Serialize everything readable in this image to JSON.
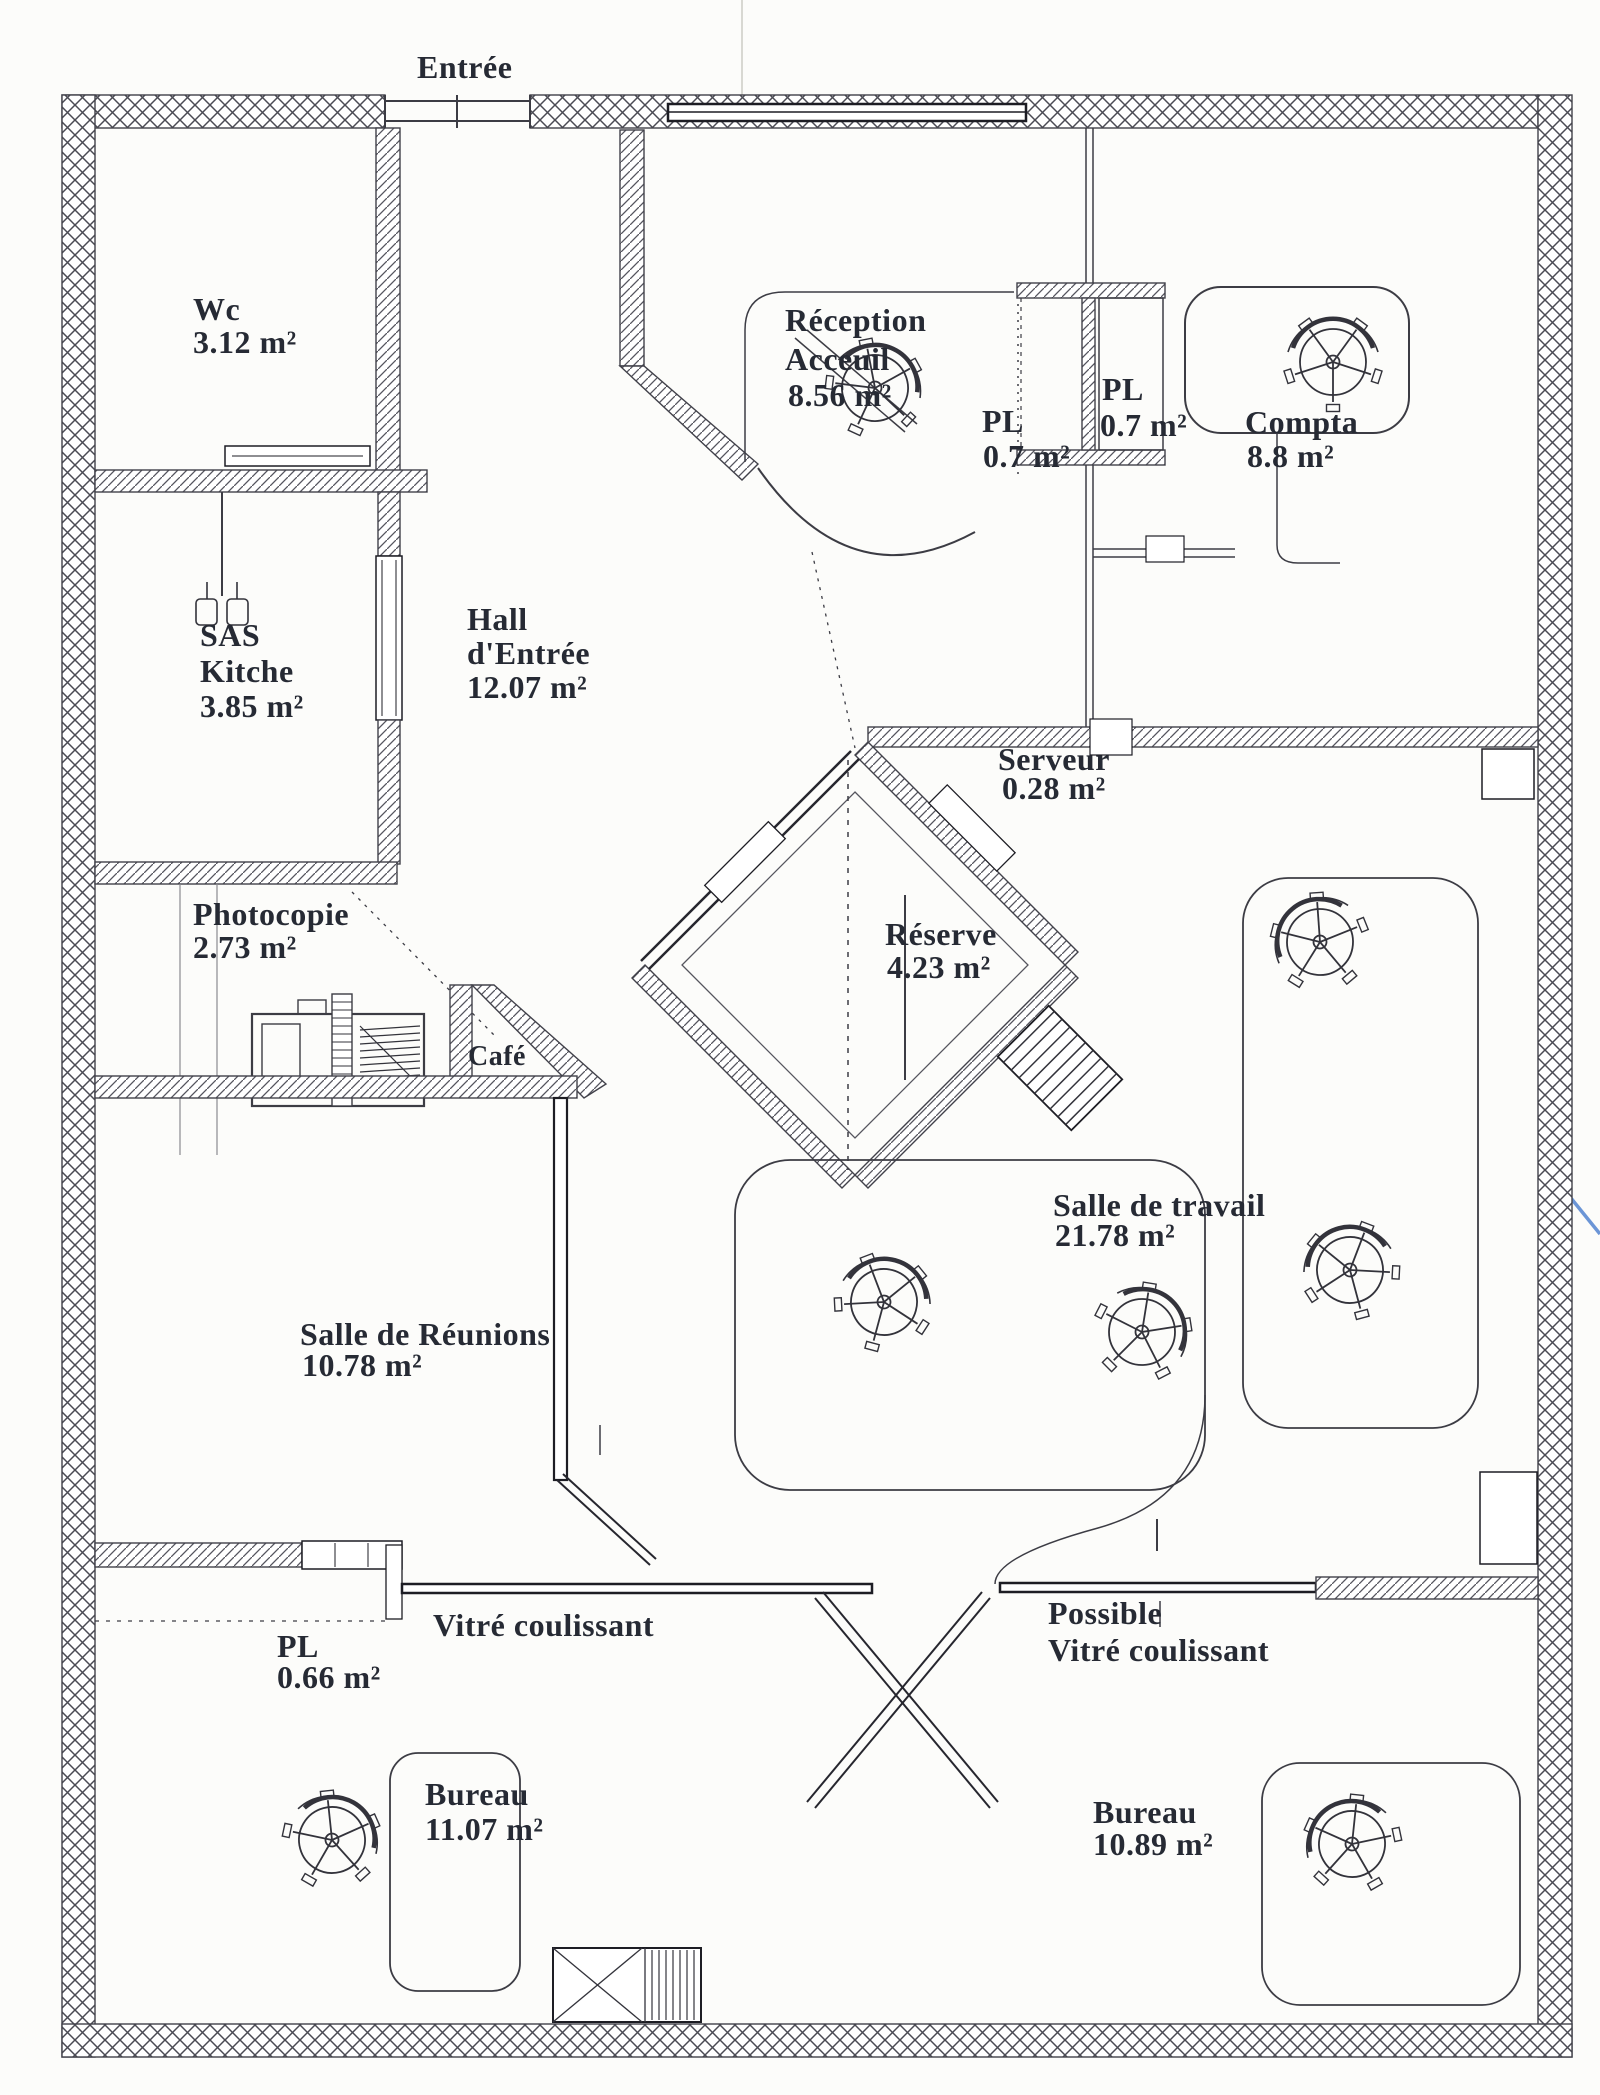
{
  "annotations": {
    "entree": "Entrée",
    "vitre_coulissant": "Vitré coulissant",
    "possible_line1": "Possible",
    "possible_line2": "Vitré coulissant"
  },
  "rooms": {
    "wc": {
      "line1": "Wc",
      "line2": "3.12 m²"
    },
    "reception": {
      "line1": "Réception",
      "line2": "Acceuil",
      "line3": "8.56 m²"
    },
    "pl_top_left": {
      "line1": "PL",
      "line2": "0.7 m²"
    },
    "pl_top_right": {
      "line1": "PL",
      "line2": "0.7 m²"
    },
    "compta": {
      "line1": "Compta",
      "line2": "8.8 m²"
    },
    "sas_kitche": {
      "line1": "SAS",
      "line2": "Kitche",
      "line3": "3.85 m²"
    },
    "hall": {
      "line1": "Hall",
      "line2": "d'Entrée",
      "line3": "12.07 m²"
    },
    "serveur": {
      "line1": "Serveur",
      "line2": "0.28 m²"
    },
    "photocopie": {
      "line1": "Photocopie",
      "line2": "2.73 m²"
    },
    "reserve": {
      "line1": "Réserve",
      "line2": "4.23 m²"
    },
    "cafe": {
      "line1": "Café"
    },
    "salle_travail": {
      "line1": "Salle de travail",
      "line2": "21.78 m²"
    },
    "salle_reunions": {
      "line1": "Salle de Réunions",
      "line2": "10.78 m²"
    },
    "pl_bottom": {
      "line1": "PL",
      "line2": "0.66 m²"
    },
    "bureau_gauche": {
      "line1": "Bureau",
      "line2": "11.07 m²"
    },
    "bureau_droit": {
      "line1": "Bureau",
      "line2": "10.89 m²"
    }
  },
  "icons": {
    "office_chair": "office-chair-plan-symbol",
    "photocopier": "photocopier-plan-symbol",
    "sink": "kitchen-sink-plan-symbol",
    "window": "window-plan-symbol",
    "door": "door-leaf-plan-symbol",
    "shelf": "shelf-ladder-plan-symbol"
  },
  "colors": {
    "paper": "#fcfcfa",
    "ink": "#262a34",
    "wall": "#41414a",
    "blue_mark": "#6b95d6"
  }
}
